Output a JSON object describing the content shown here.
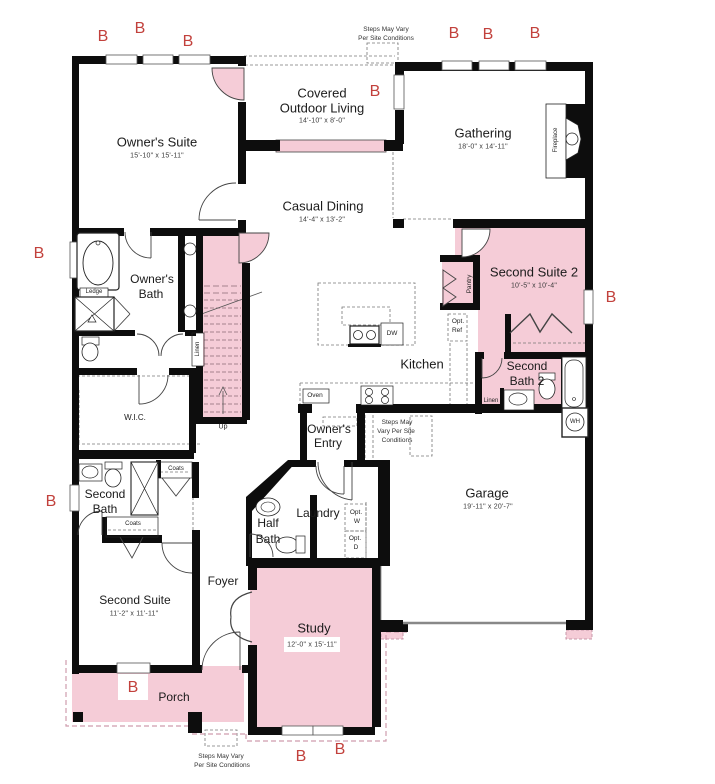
{
  "colors": {
    "room_fill_pink": "#f5ccd7",
    "wall_black": "#0d0d0d",
    "marker_red": "#c2413c",
    "dashed_gray": "#777777",
    "dashed_pink": "#cf9cad"
  },
  "markers": [
    "B",
    "B",
    "B",
    "B",
    "B",
    "B",
    "B",
    "B",
    "B",
    "B",
    "B",
    "B",
    "B"
  ],
  "rooms": {
    "owners_suite": {
      "name": "Owner's Suite",
      "dims": "15'-10\" x 15'-11\""
    },
    "covered_outdoor": {
      "line1": "Covered",
      "line2": "Outdoor Living",
      "dims": "14'-10\" x 8'-0\""
    },
    "gathering": {
      "name": "Gathering",
      "dims": "18'-0\" x 14'-11\""
    },
    "casual_dining": {
      "name": "Casual Dining",
      "dims": "14'-4\" x 13'-2\""
    },
    "owners_bath": {
      "line1": "Owner's",
      "line2": "Bath"
    },
    "wic": {
      "name": "W.I.C."
    },
    "kitchen": {
      "name": "Kitchen"
    },
    "second_suite2": {
      "name": "Second Suite 2",
      "dims": "10'-5\" x 10'-4\""
    },
    "second_bath2": {
      "line1": "Second",
      "line2": "Bath 2"
    },
    "garage": {
      "name": "Garage",
      "dims": "19'-11\" x 20'-7\""
    },
    "owners_entry": {
      "line1": "Owner's",
      "line2": "Entry"
    },
    "laundry": {
      "name": "Laundry"
    },
    "half_bath": {
      "line1": "Half",
      "line2": "Bath"
    },
    "second_bath": {
      "line1": "Second",
      "line2": "Bath"
    },
    "second_suite": {
      "name": "Second Suite",
      "dims": "11'-2\" x 11'-11\""
    },
    "foyer": {
      "name": "Foyer"
    },
    "study": {
      "name": "Study",
      "dims": "12'-0\" x 15'-11\""
    },
    "porch": {
      "name": "Porch"
    }
  },
  "labels": {
    "ledge": "Ledge",
    "linen_stairs": "Linen",
    "linen_bath2": "Linen",
    "coats_upper": "Coats",
    "coats_lower": "Coats",
    "oven": "Oven",
    "dw": "DW",
    "opt_ref": [
      "Opt.",
      "Ref"
    ],
    "opt_w": [
      "Opt.",
      "W"
    ],
    "opt_d": [
      "Opt.",
      "D"
    ],
    "pantry": "Pantry",
    "fireplace": "Fireplace",
    "wh": "WH",
    "up": "Up"
  },
  "notes": {
    "steps_top": [
      "Steps May Vary",
      "Per Site Conditions"
    ],
    "steps_mid": [
      "Steps May",
      "Vary Per Site",
      "Conditions"
    ],
    "steps_bottom": [
      "Steps May Vary",
      "Per Site Conditions"
    ]
  }
}
